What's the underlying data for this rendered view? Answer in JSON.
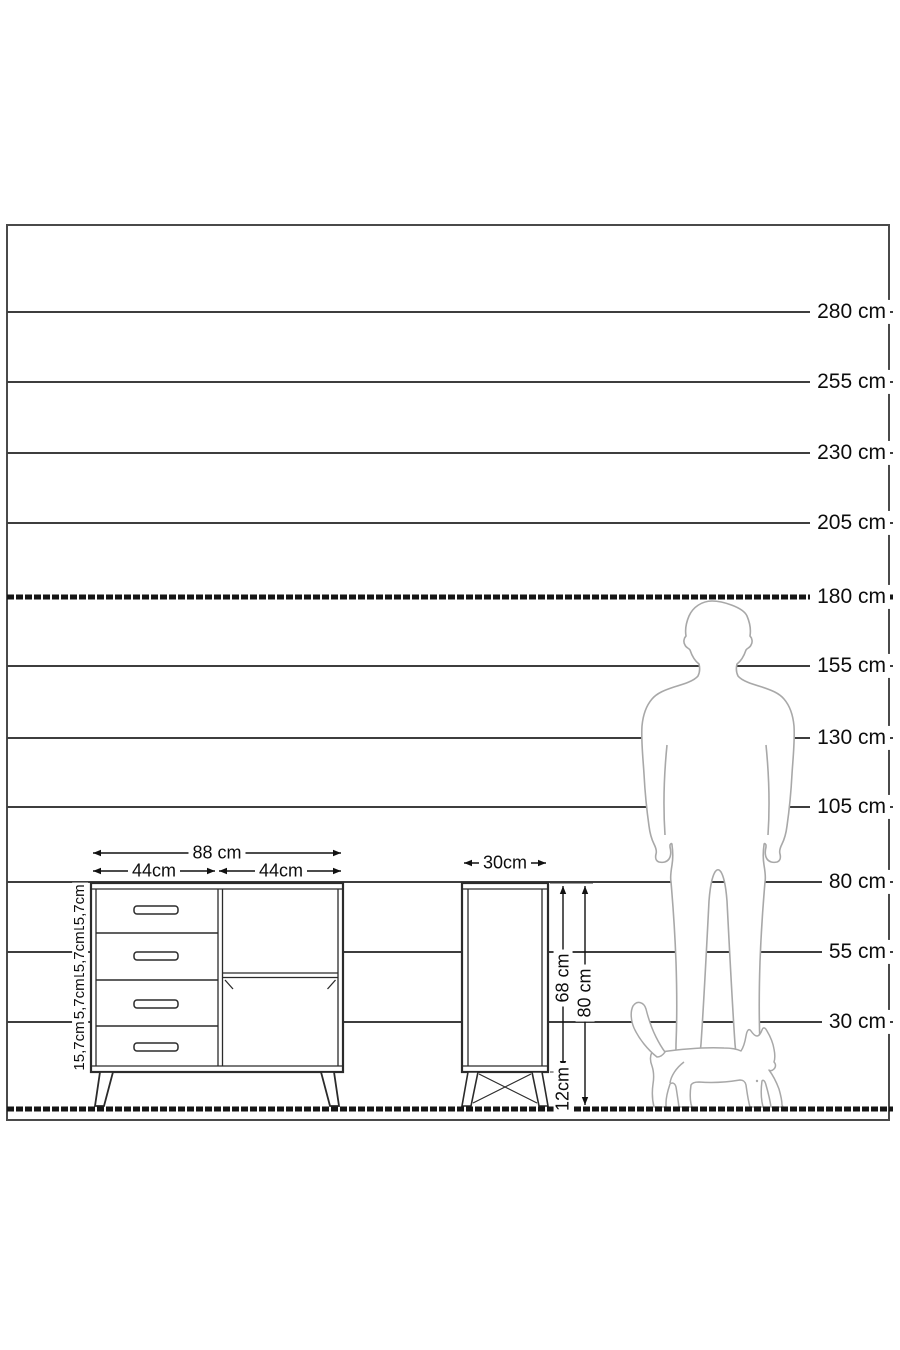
{
  "diagram": {
    "kind": "furniture-dimension-diagram",
    "unit": "cm"
  },
  "scale": {
    "lines": [
      {
        "label": "280 cm",
        "value_cm": 280
      },
      {
        "label": "255 cm",
        "value_cm": 255
      },
      {
        "label": "230 cm",
        "value_cm": 230
      },
      {
        "label": "205 cm",
        "value_cm": 205
      },
      {
        "label": "180 cm",
        "value_cm": 180
      },
      {
        "label": "155 cm",
        "value_cm": 155
      },
      {
        "label": "130 cm",
        "value_cm": 130
      },
      {
        "label": "105 cm",
        "value_cm": 105
      },
      {
        "label": "80 cm",
        "value_cm": 80
      },
      {
        "label": "55 cm",
        "value_cm": 55
      },
      {
        "label": "30 cm",
        "value_cm": 30
      }
    ]
  },
  "front_view": {
    "overall_width_label": "88 cm",
    "left_section_width_label": "44cm",
    "right_section_width_label": "44cm",
    "drawer_height_labels": [
      "15,7cm",
      "15,7cm",
      "15,7cm",
      "15,7cm"
    ],
    "drawer_count": 4
  },
  "side_view": {
    "depth_label": "30cm",
    "carcass_height_label": "68 cm",
    "leg_height_label": "12cm",
    "overall_height_label": "80 cm"
  },
  "figures": {
    "man": "man-silhouette",
    "cat": "cat-silhouette"
  },
  "colors": {
    "scale_line": "#3d3d3d",
    "dashed_line": "#161616",
    "furniture_line": "#2b2b2b",
    "silhouette_outline": "#a8a8a8",
    "text": "#0d0d0d",
    "background": "#ffffff"
  }
}
